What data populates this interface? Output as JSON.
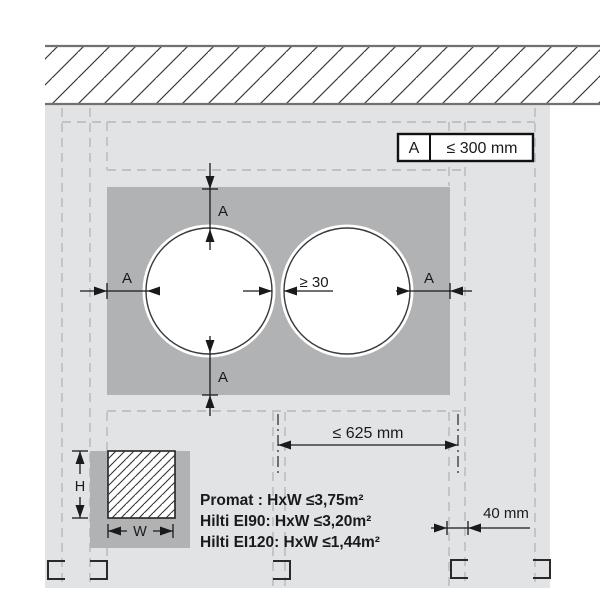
{
  "diagram_title": "wall-penetration-seal-detail",
  "labels": {
    "a": "A",
    "gap": "≥ 30",
    "span": "≤ 625 mm",
    "offset": "40 mm",
    "h": "H",
    "w": "W"
  },
  "legend": {
    "key": "A",
    "value": "≤ 300 mm"
  },
  "notes": {
    "lines": [
      "Promat : HxW ≤3,75m²",
      "Hilti EI90: HxW ≤3,20m²",
      "Hilti EI120: HxW ≤1,44m²"
    ]
  },
  "colors": {
    "wall_face": "#e2e3e5",
    "seal_panel": "#b1b2b4",
    "hidden_line": "#b6b8bb",
    "dimension_line": "#1a1a1a",
    "hatch_line": "#3d3d3d",
    "band_border": "#6f7173"
  }
}
